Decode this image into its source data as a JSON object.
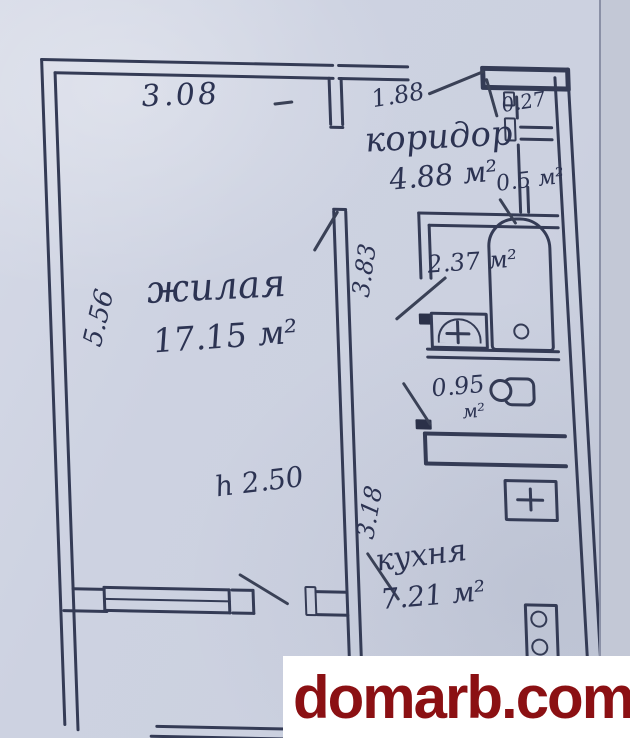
{
  "watermark": {
    "text": "domarb.com",
    "color": "#8b1013"
  },
  "colors": {
    "ink": "#343b55",
    "paper": "#ccd1e0"
  },
  "plan": {
    "rooms": {
      "living": {
        "name": "жилая",
        "area": "17.15 м²"
      },
      "corridor": {
        "name": "коридор",
        "area": "4.88 м²"
      },
      "kitchen": {
        "name": "кухня",
        "area": "7.21 м²"
      },
      "bathroom": {
        "area": "2.37 м²"
      },
      "toilet": {
        "area_value": "0.95",
        "area_unit": "м²"
      },
      "closet_small": {
        "area": "0.27"
      },
      "closet": {
        "area": "0.5 м²"
      }
    },
    "dimensions": {
      "living_top_width": "3.08",
      "corridor_top_width": "1.88",
      "living_left_height": "5.56",
      "hall_mid_height": "3.83",
      "kitchen_left_height": "3.18",
      "ceiling_height": "h 2.50"
    }
  }
}
